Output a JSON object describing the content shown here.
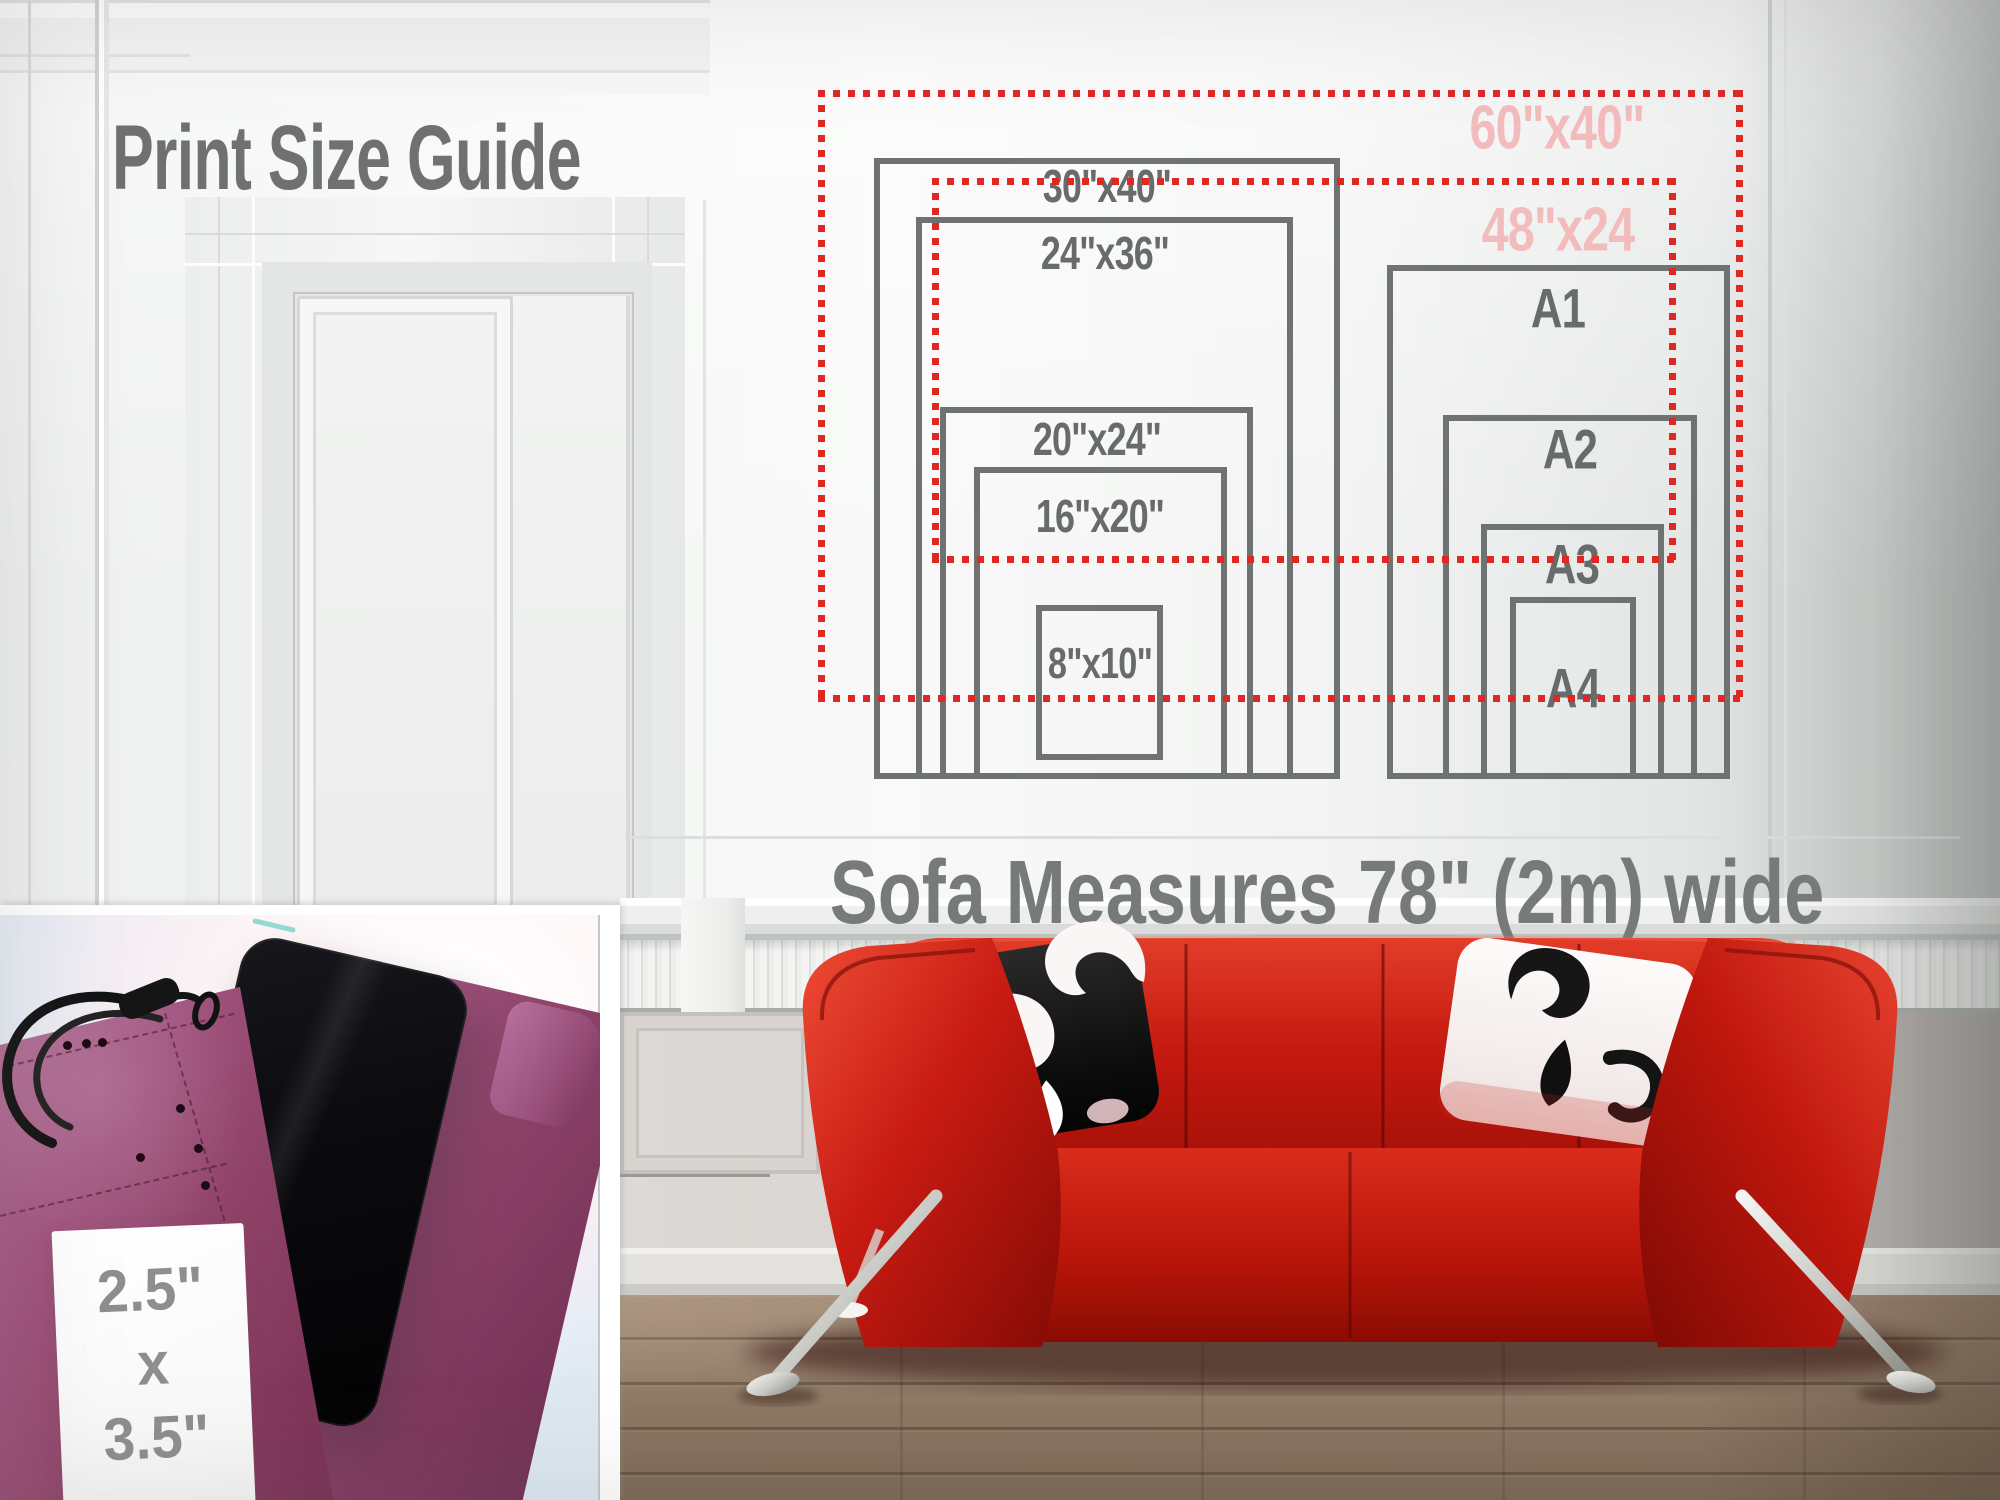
{
  "page": {
    "title": "Print Size Guide",
    "sofa_caption": "Sofa Measures 78\" (2m) wide"
  },
  "colors": {
    "frame_gray": "#6e7271",
    "label_gray": "#676b6a",
    "dotted_red": "#e02823",
    "pink_label": "#f2bcbc",
    "sofa_red": "#c01610",
    "wall_white": "#f3f4f3",
    "case_magenta": "#a25580"
  },
  "size_guide": {
    "frames": [
      {
        "id": "frame-30x40",
        "label": "30\"x40\"",
        "style": "solid",
        "box": [
          874,
          158,
          466,
          621
        ],
        "label_at": [
          1107,
          186
        ],
        "font": 46,
        "label_color": "#676b6a",
        "z": 1,
        "lz": 2
      },
      {
        "id": "frame-24x36",
        "label": "24\"x36\"",
        "style": "solid",
        "box": [
          916,
          217,
          377,
          562
        ],
        "label_at": [
          1105,
          253
        ],
        "font": 46,
        "label_color": "#676b6a",
        "z": 1,
        "lz": 2
      },
      {
        "id": "frame-20x24",
        "label": "20\"x24\"",
        "style": "solid",
        "box": [
          940,
          407,
          313,
          372
        ],
        "label_at": [
          1097,
          439
        ],
        "font": 46,
        "label_color": "#676b6a",
        "z": 1,
        "lz": 2
      },
      {
        "id": "frame-16x20",
        "label": "16\"x20\"",
        "style": "solid",
        "box": [
          974,
          467,
          253,
          312
        ],
        "label_at": [
          1100,
          516
        ],
        "font": 46,
        "label_color": "#676b6a",
        "z": 1,
        "lz": 2
      },
      {
        "id": "frame-8x10",
        "label": "8\"x10\"",
        "style": "solid",
        "box": [
          1036,
          605,
          127,
          155
        ],
        "label_at": [
          1100,
          664
        ],
        "font": 44,
        "label_color": "#676b6a",
        "z": 1,
        "lz": 2
      },
      {
        "id": "frame-a1",
        "label": "A1",
        "style": "solid",
        "box": [
          1387,
          265,
          343,
          514
        ],
        "label_at": [
          1558,
          308
        ],
        "font": 56,
        "label_color": "#676b6a",
        "z": 1,
        "lz": 2
      },
      {
        "id": "frame-a2",
        "label": "A2",
        "style": "solid",
        "box": [
          1443,
          415,
          254,
          364
        ],
        "label_at": [
          1570,
          449
        ],
        "font": 56,
        "label_color": "#676b6a",
        "z": 1,
        "lz": 2
      },
      {
        "id": "frame-a3",
        "label": "A3",
        "style": "solid",
        "box": [
          1481,
          524,
          183,
          255
        ],
        "label_at": [
          1572,
          564
        ],
        "font": 56,
        "label_color": "#676b6a",
        "z": 1,
        "lz": 2
      },
      {
        "id": "frame-a4",
        "label": "A4",
        "style": "solid",
        "box": [
          1510,
          597,
          126,
          182
        ],
        "label_at": [
          1573,
          688
        ],
        "font": 56,
        "label_color": "#676b6a",
        "z": 1,
        "lz": 2
      },
      {
        "id": "frame-60x40",
        "label": "60\"x40\"",
        "style": "dotted",
        "box": [
          818,
          90,
          925,
          612
        ],
        "label_at": [
          1557,
          128
        ],
        "font": 62,
        "label_color": "#f2bcbc",
        "z": 3,
        "lz": 4
      },
      {
        "id": "frame-48x24",
        "label": "48\"x24",
        "style": "dotted",
        "box": [
          932,
          178,
          744,
          385
        ],
        "label_at": [
          1558,
          230
        ],
        "font": 62,
        "label_color": "#f2bcbc",
        "z": 3,
        "lz": 4
      }
    ]
  },
  "inset": {
    "card_lines": [
      "2.5\"",
      "x",
      "3.5\""
    ]
  }
}
